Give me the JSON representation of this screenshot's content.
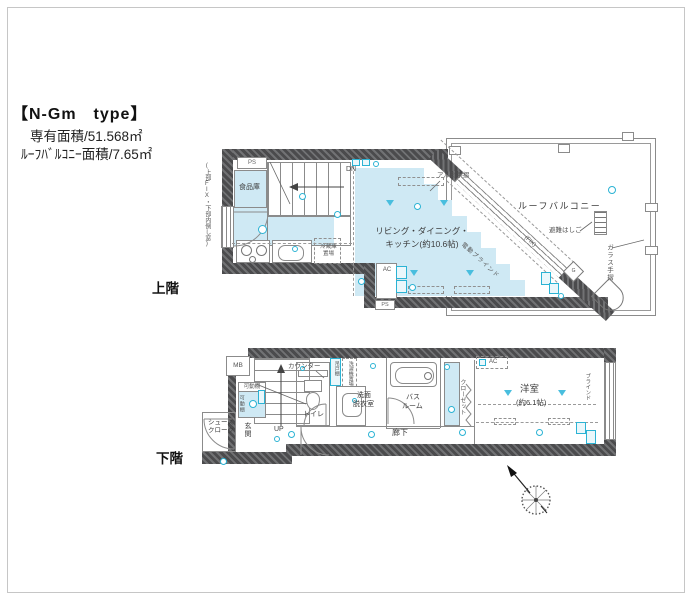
{
  "header": {
    "title": "【N-Gm　type】",
    "area_main": "専有面積/51.568㎡",
    "area_balcony": "ﾙｰﾌﾊﾞﾙｺﾆｰ面積/7.65㎡"
  },
  "upper": {
    "floor_label": "上階",
    "ps": "PS",
    "ps_small": "PS",
    "pantry": "食品庫",
    "window_note": "(上部FIX・下部内倒し窓)",
    "dn": "DN",
    "fridge_line1": "冷蔵庫",
    "fridge_line2": "置場",
    "ldk_line1": "リビング・ダイニング・",
    "ldk_line2": "キッチン(約10.6帖)",
    "ac": "AC",
    "aluminum_rail": "アルミ手摺",
    "roof_balcony": "ルーフバルコニー",
    "escape_ladder": "避難はしご",
    "glass_rail": "ガラス手摺",
    "motor_blind": "電動ブラインド",
    "fix_window": "(FIX)",
    "gas_mark": "G"
  },
  "lower": {
    "floor_label": "下階",
    "mb": "MB",
    "movable_shelf": "可動棚",
    "movable_shelf_v": "可動棚",
    "counter": "カウンター",
    "toilet": "トイレ",
    "up": "UP",
    "hanging_cupboard": "吊戸棚",
    "washer_space": "洗濯機置場",
    "washroom_line1": "洗面",
    "washroom_line2": "脱衣室",
    "bathroom_line1": "バス",
    "bathroom_line2": "ルーム",
    "hallway": "廊下",
    "entrance": "玄関",
    "shoe_line1": "シューズ",
    "shoe_line2": "クローク",
    "closet": "クローゼット",
    "bedroom": "洋室",
    "bedroom_size": "(約6.1帖)",
    "blind": "ブラインド",
    "ac": "AC"
  },
  "colors": {
    "wall_gray": "#58585a",
    "room_blue": "#cfe9f4",
    "fixture_cyan": "#2bb3d4"
  }
}
